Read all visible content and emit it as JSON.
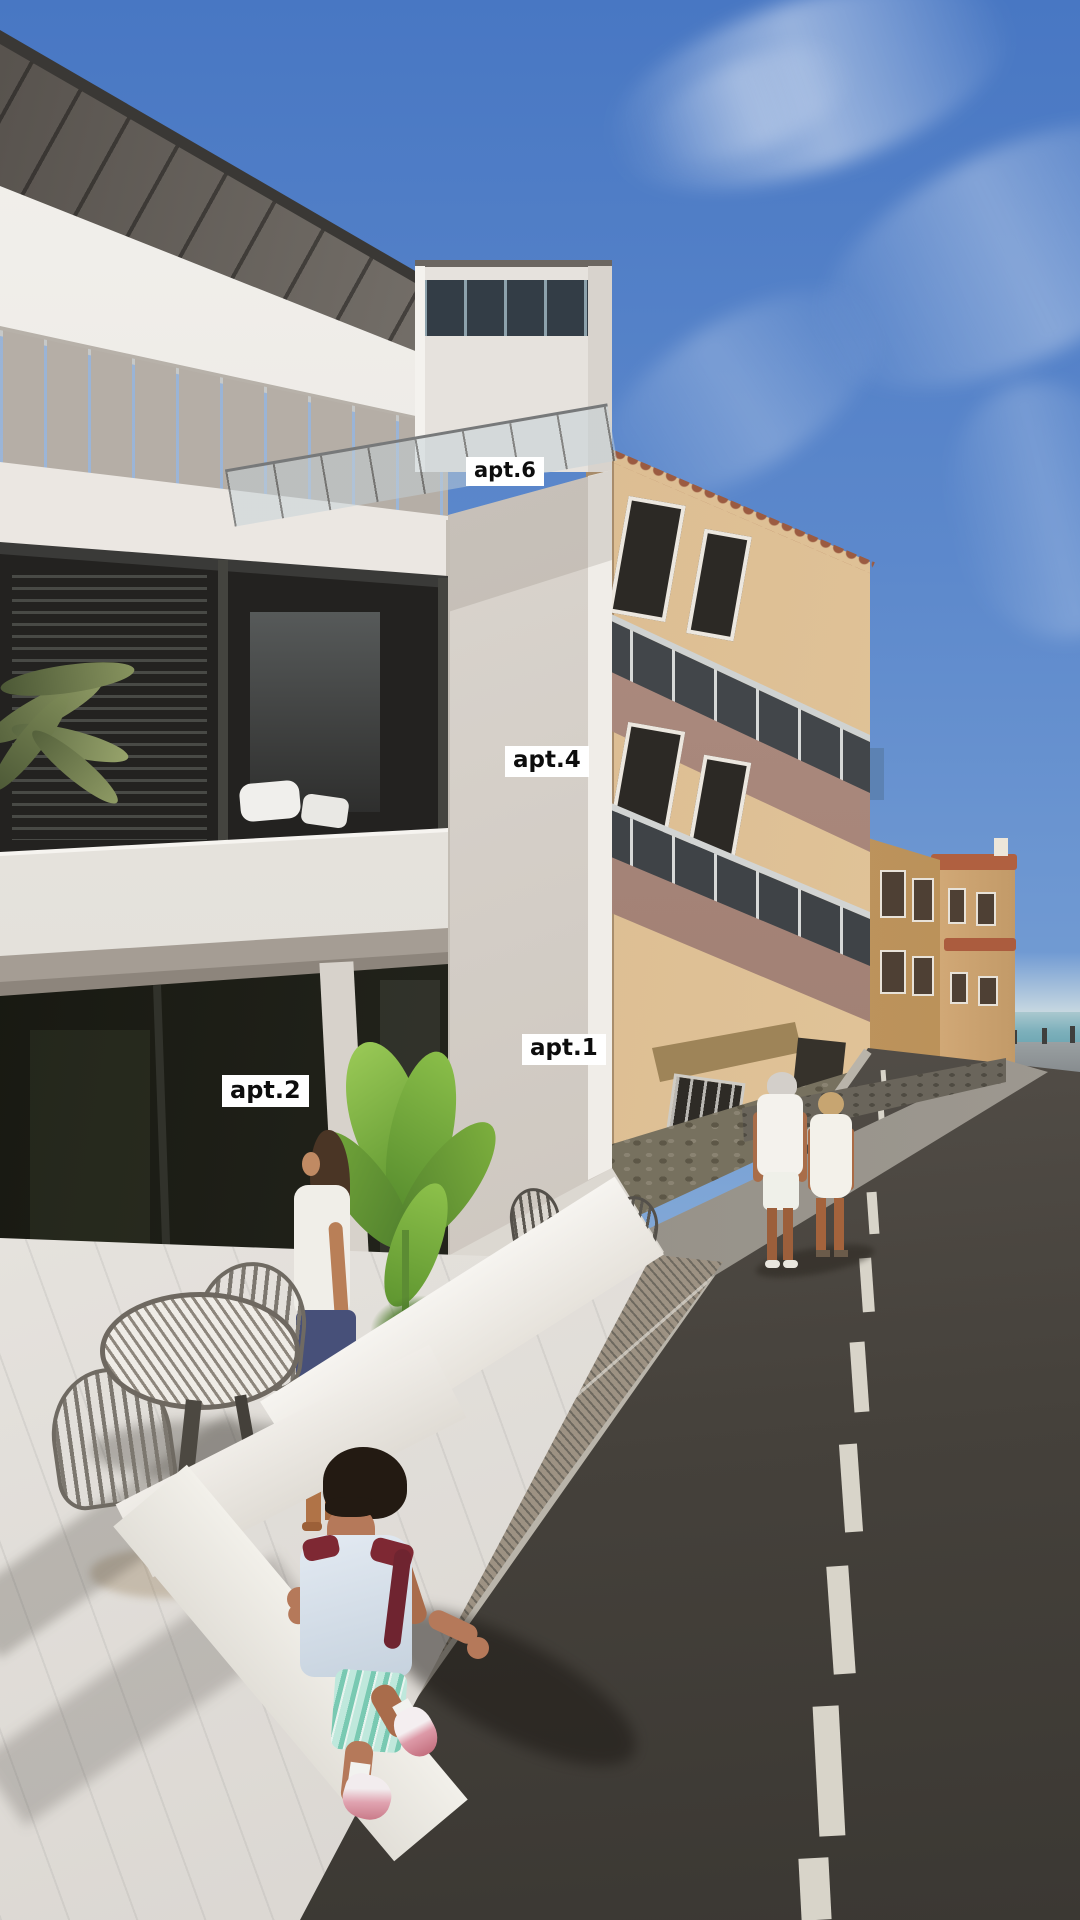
{
  "scene": {
    "labels": [
      {
        "id": "apt6",
        "text": "apt.6"
      },
      {
        "id": "apt4",
        "text": "apt.4"
      },
      {
        "id": "apt1",
        "text": "apt.1"
      },
      {
        "id": "apt2",
        "text": "apt.2"
      }
    ],
    "palette": {
      "sky_top": "#4877c3",
      "sky_horizon": "#b9cedd",
      "sea": "#5f9dab",
      "white_building": "#e8e4df",
      "white_building_shadow": "#b5aea6",
      "beige_building": "#dcbd92",
      "balcony_parapet": "#a5837a",
      "terracotta_roof": "#b06040",
      "road_near": "#3f3b35",
      "road_far": "#7d7567",
      "sidewalk": "#9b958b",
      "marble_floor": "#e8e5e0",
      "plant_green": "#7fb23e",
      "label_background": "#ffffff",
      "label_text": "#0d0d0d"
    }
  }
}
